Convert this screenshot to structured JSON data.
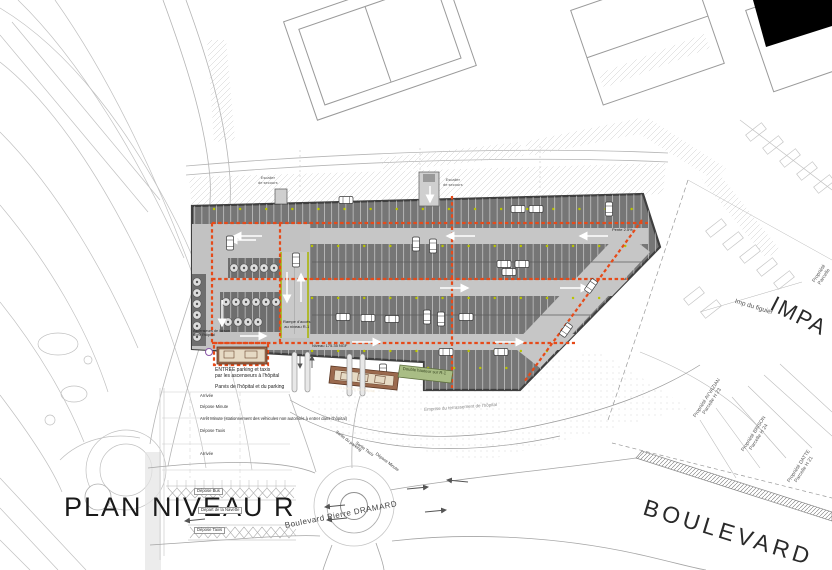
{
  "plan": {
    "title": "PLAN NIVEAU R"
  },
  "streets": {
    "dramard": "Boulevard   Pierre   DRAMARD",
    "boulevard": "BOULEVARD",
    "impasse": "IMPA",
    "imp_figuier": "Imp du figuier"
  },
  "parcels": [
    {
      "label": "Propriété AYVAZIAN\nParcelle H 23"
    },
    {
      "label": "Propriété BRISON\nParcelle H 24"
    },
    {
      "label": "Propriété DATTE\nParcelle H 21"
    },
    {
      "label": "Propriété\nParcelle"
    }
  ],
  "parking": {
    "stair_left": "Escalier\nde secours",
    "stair_top": "Escalier\nde secours",
    "ramp": "Rampe d'accès\nau niveau R-1",
    "level": "Niveau 175.35 NGF",
    "slope": "Pente 2.5%",
    "elevators": "Ascenseurs de liaison\navec l'hôpital",
    "double_height": "Double hauteur sur R-1",
    "navette_stop": "Arrêt Navette de l'hôpital"
  },
  "entry": {
    "entree": "ENTREE parking et taxis\npar les ascenseurs à l'hôpital",
    "parvis": "Parvis de l'hôpital et du parking"
  },
  "drop_off": {
    "arrivee": "Arrivée",
    "depose_minute": "Dépose Minute",
    "arret_minute": "Arrêt Minute (stationnement des véhicules non autorisés à entrer dans l'hôpital)",
    "depose_taxis": "Dépose Taxis",
    "arrivee2": "Arrivée",
    "depose_bus": "Dépose Bus",
    "depart_navette": "Départ de la Navette",
    "depose_taxis2": "Dépose Taxis",
    "sortie_parking": "Sortie du parking",
    "sortie_taxis": "Sortie Taxis",
    "sortie_depose": "Dépose Minute"
  },
  "site": {
    "terrassement": "Emprise du terrassement de l'hôpital"
  },
  "colors": {
    "zone_dashed": "#e64a19",
    "column_dot": "#b9c400",
    "slab_dark": "#767676",
    "aisle_light": "#c6c6c6",
    "green_roof": "#a9bd85",
    "building_brown": "#9b6a4e"
  }
}
